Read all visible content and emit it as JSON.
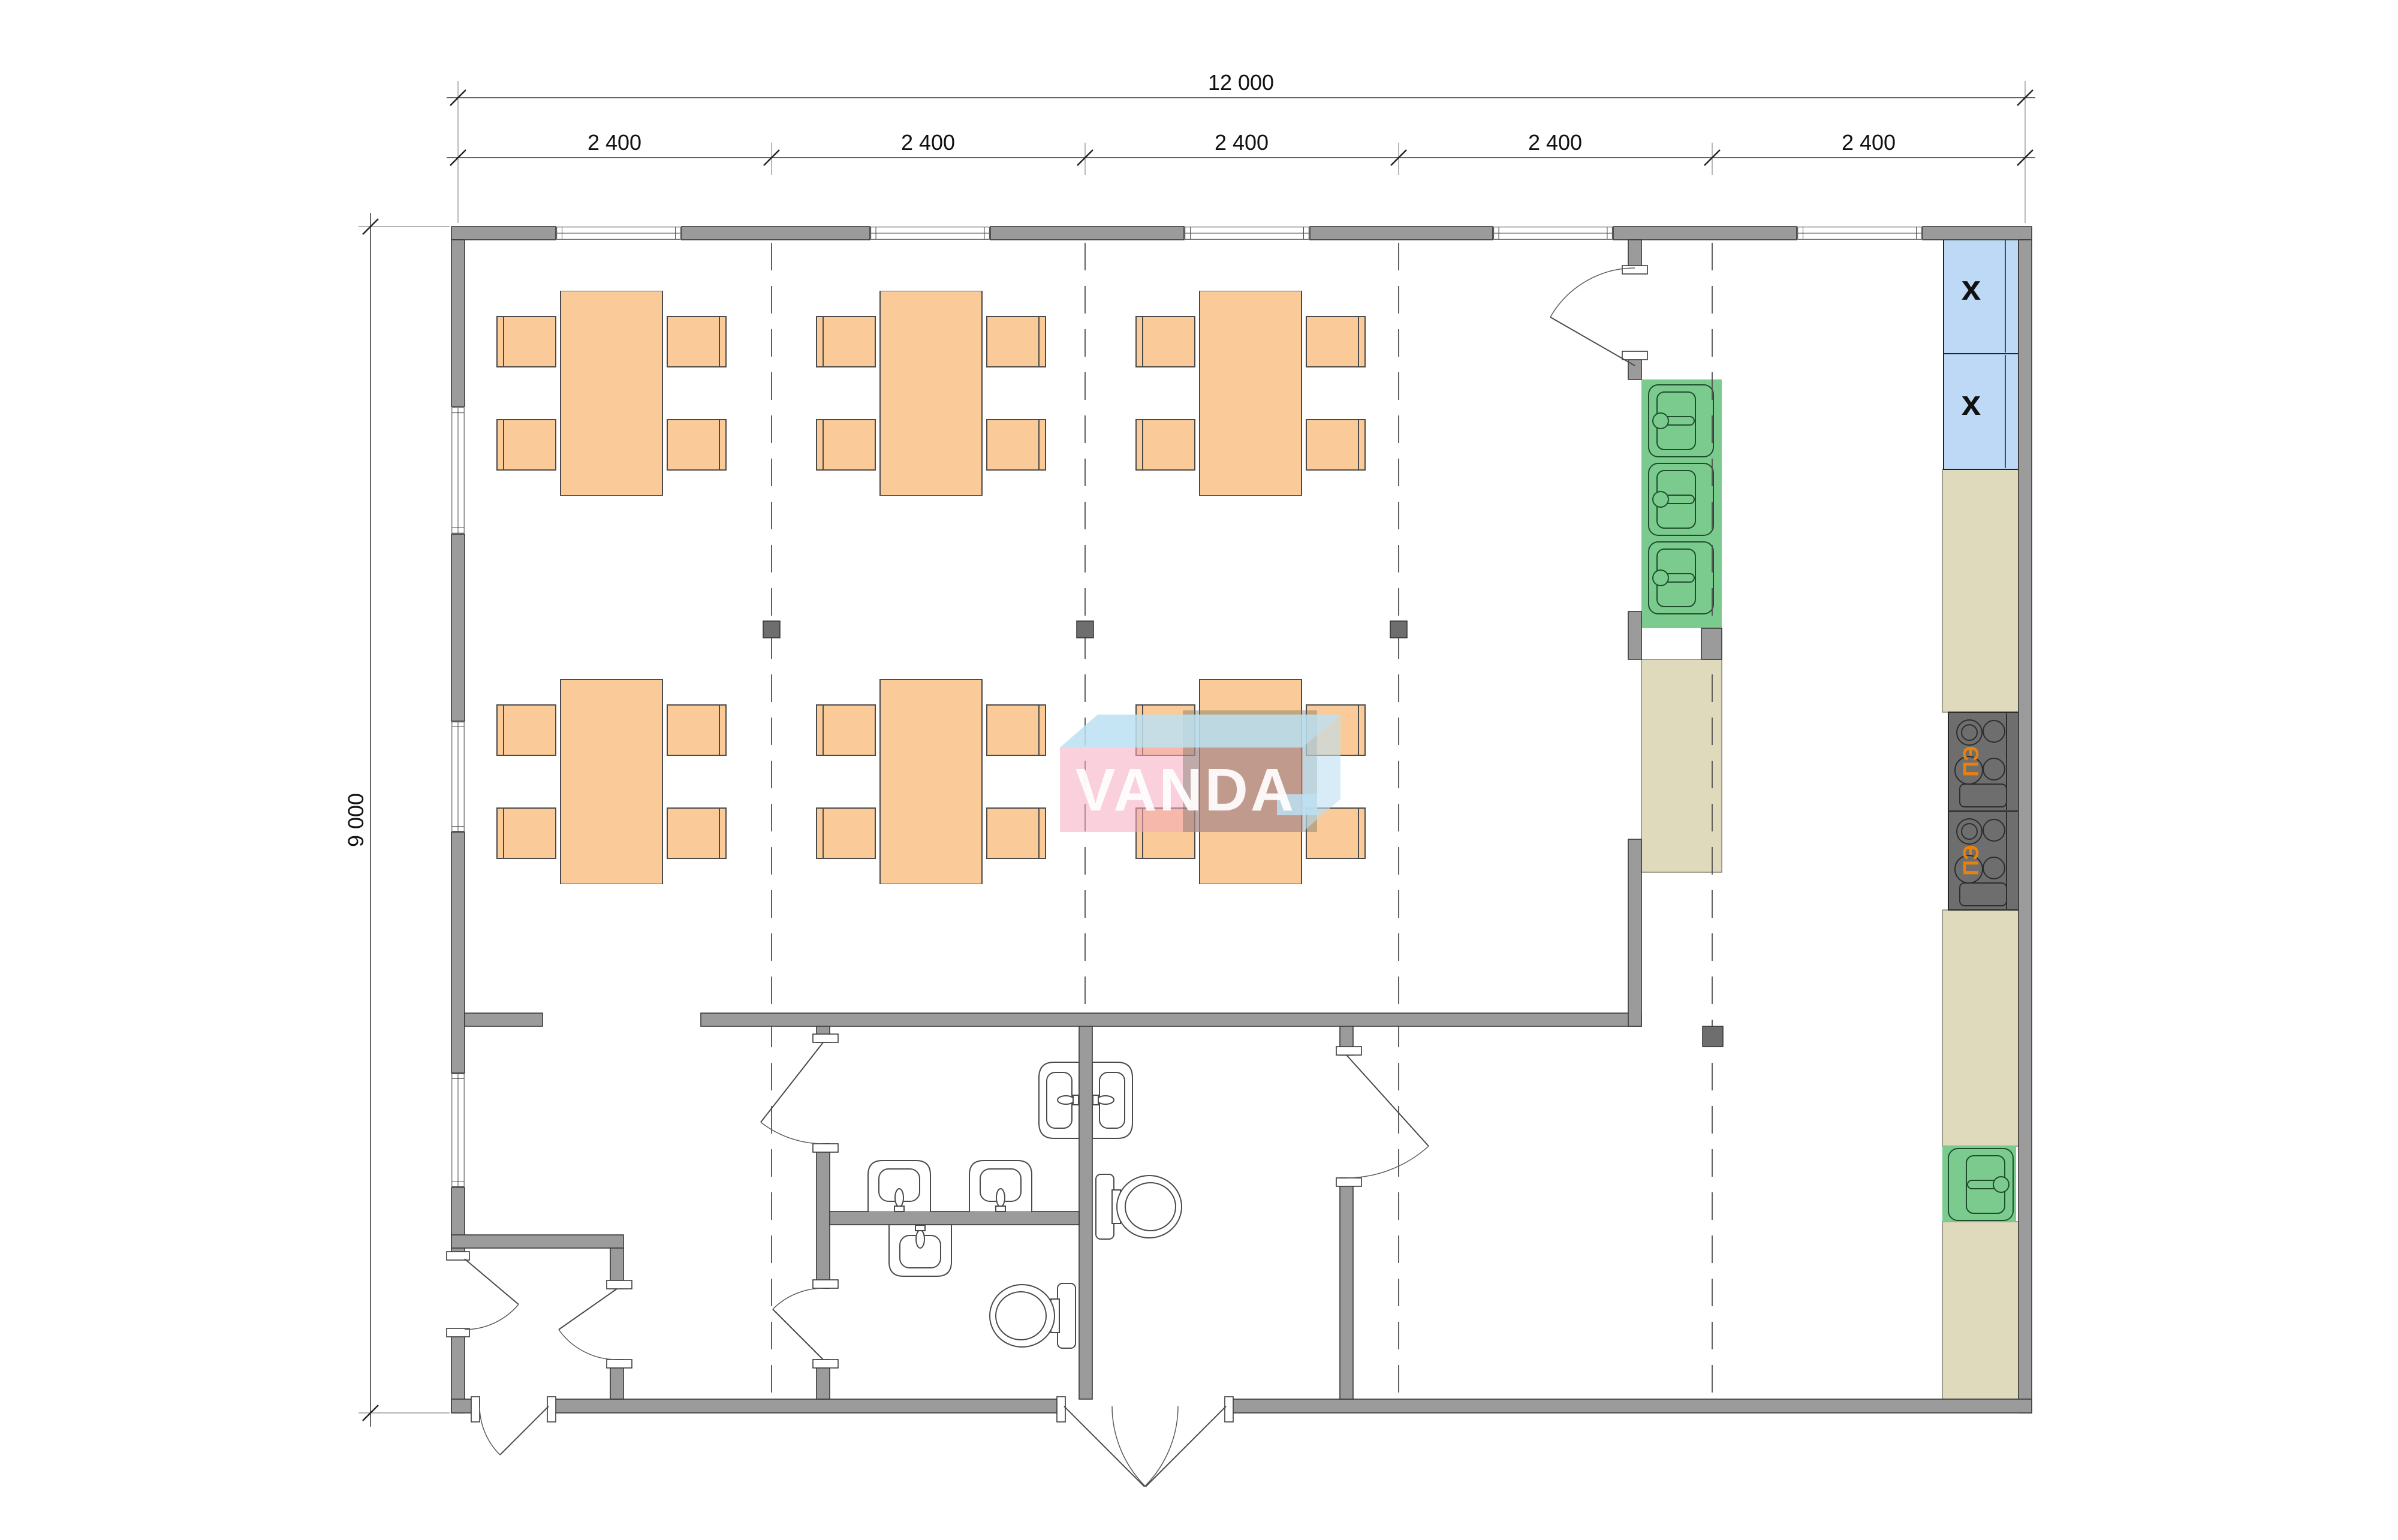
{
  "dimensions": {
    "total_width": "12 000",
    "total_height": "9 000",
    "bays": [
      "2 400",
      "2 400",
      "2 400",
      "2 400",
      "2 400"
    ]
  },
  "kitchen": {
    "stove_label": "ПЭ",
    "stove_count": 2,
    "fridge_mark": "x",
    "fridge_count": 2,
    "wash_sink_units": 3,
    "prep_sink_units": 1,
    "counter_color": "#E0DABC",
    "sink_color": "#7CCB8E",
    "fridge_color": "#BDD9F6",
    "stove_color": "#6E6E6E",
    "stove_label_color": "#E8820C"
  },
  "dining": {
    "tables": 6,
    "chairs_per_table": 4,
    "furniture_color": "#FACB98"
  },
  "sanitary": {
    "washbasins": 6,
    "toilets": 2
  },
  "watermark": {
    "text": "VANDA",
    "front_color": "#F4A9BD",
    "top_color": "#BCE0F2"
  },
  "colors": {
    "wall": "#9B9B9B",
    "background": "#FFFFFF"
  }
}
